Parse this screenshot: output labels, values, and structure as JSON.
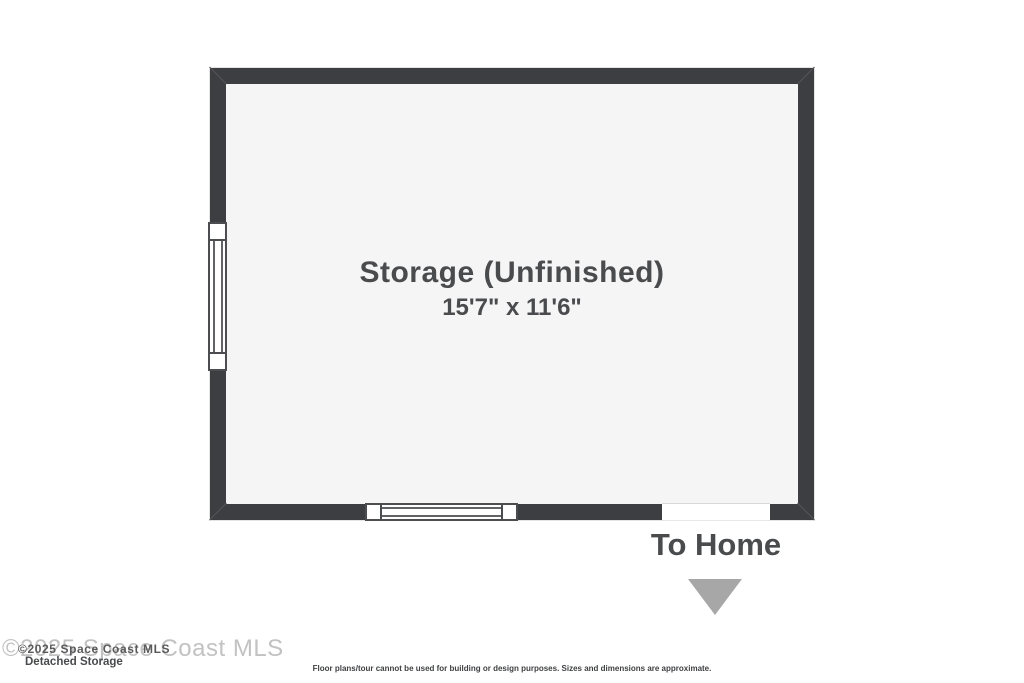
{
  "floorplan": {
    "room": {
      "label": "Storage (Unfinished)",
      "dimensions": "15'7\" x 11'6\""
    },
    "exit": {
      "label": "To Home"
    },
    "features": {
      "left_window": "window",
      "bottom_window": "window",
      "bottom_opening": "doorway-to-home"
    }
  },
  "footer": {
    "watermark_large": "©2025 Space Coast MLS",
    "watermark_small": "©2025 Space Coast MLS",
    "plan_name": "Detached Storage",
    "disclaimer": "Floor plans/tour cannot be used for building or design purposes. Sizes and dimensions are approximate."
  },
  "colors": {
    "wall": "#3d3e42",
    "floor": "#f5f5f6",
    "text": "#4a4b4d",
    "arrow": "#a7a7a7",
    "watermark": "#c2c2c2",
    "background": "#ffffff"
  }
}
